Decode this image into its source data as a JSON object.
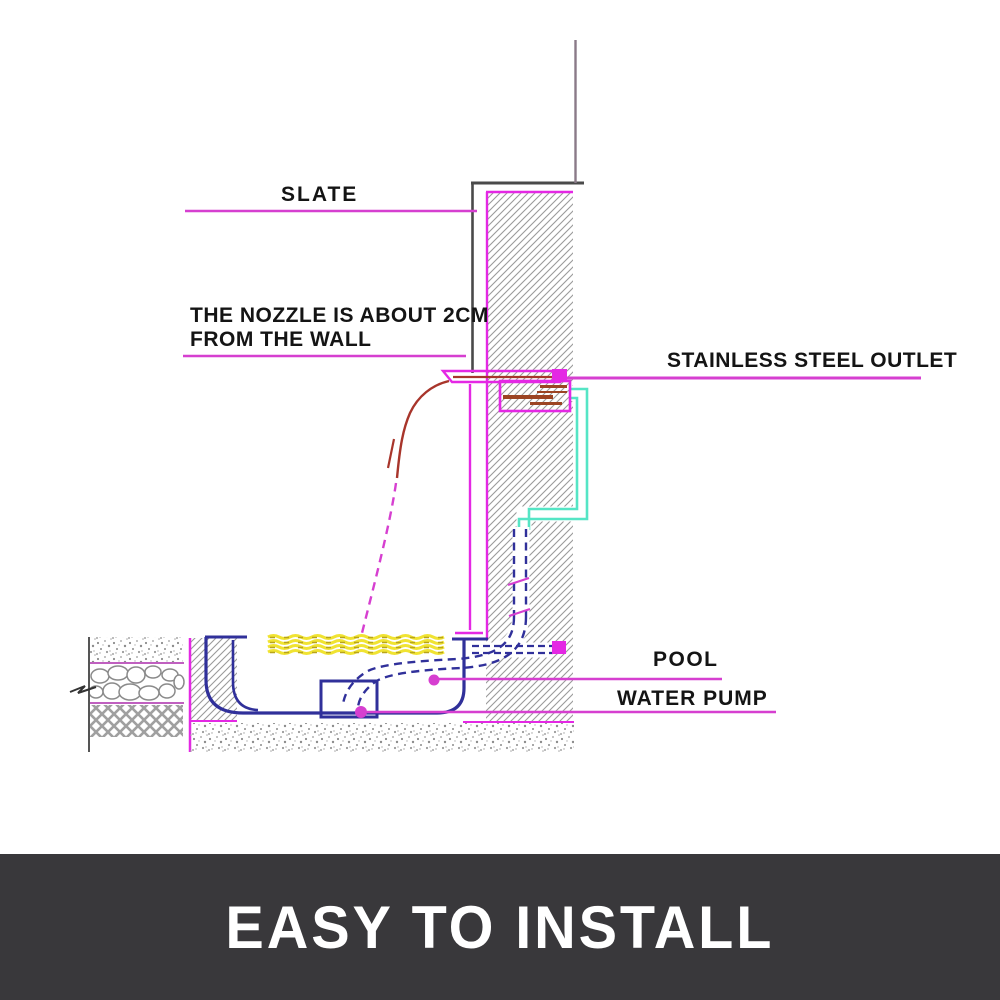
{
  "diagram": {
    "labels": {
      "slate": "SLATE",
      "nozzle_line1": "THE NOZZLE IS ABOUT 2CM",
      "nozzle_line2": "FROM THE WALL",
      "stainless_outlet": "STAINLESS STEEL OUTLET",
      "pool": "POOL",
      "water_pump": "WATER PUMP"
    },
    "colors": {
      "pointer": "#d63fd0",
      "magenta": "#e428e4",
      "teal_pipe": "#55e5c5",
      "navy": "#30309a",
      "water_yellow": "#f0e332",
      "water_dash": "#b8a41a",
      "stream_red": "#a8352b",
      "outlet_bar": "#9c4423",
      "hatch_gray": "#9a9a9a",
      "banner_bg": "#39383b",
      "banner_text": "#ffffff",
      "label_text": "#141414"
    }
  },
  "banner": {
    "title": "EASY TO INSTALL"
  }
}
